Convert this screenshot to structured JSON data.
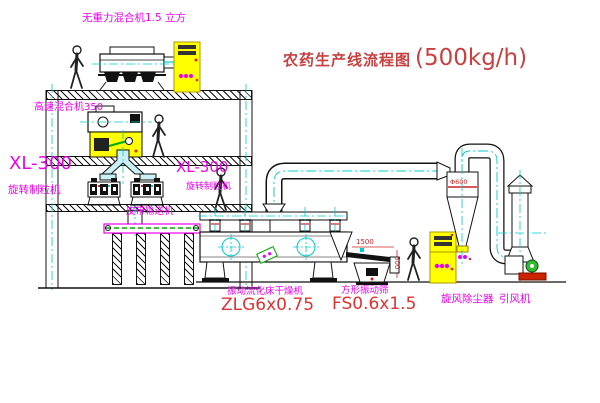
{
  "title": {
    "text": "农药生产线流程图",
    "capacity": "(500kg/h)"
  },
  "labels": {
    "gravity_mixer": "无重力混合机1.5 立方",
    "high_speed_mixer": "高速混合机350",
    "xl300_left": "XL-300",
    "granulator_left": "旋转制粒机",
    "xl300_right": "XL-300",
    "granulator_right": "旋转制粒机",
    "belt_conveyor": "皮带输送机",
    "dryer_name": "振动流化床干燥机",
    "dryer_model": "ZLG6x0.75",
    "sieve_name": "方形振动筛",
    "sieve_model": "FS0.6x1.5",
    "cyclone": "旋风除尘器",
    "fan": "引风机"
  },
  "dimensions": {
    "sieve_length": "1500",
    "sieve_height": "500",
    "cyclone_diameter": "Φ600"
  },
  "icons": {
    "worker-figure": "stick-person outline",
    "control-cabinet": "yellow panel with slots and magenta indicators",
    "centerline": "cyan dash-dot CAD centerline"
  },
  "colors": {
    "label_magenta": "#ee00ee",
    "title_red": "#c84040",
    "model_red": "#e03131",
    "dimension_red": "#cc2222",
    "centerline_cyan": "#00cccc",
    "cabinet_yellow": "#ffff00",
    "conveyor_green": "#00aa00",
    "fan_base_red": "#cc2200",
    "line_black": "#111111"
  }
}
